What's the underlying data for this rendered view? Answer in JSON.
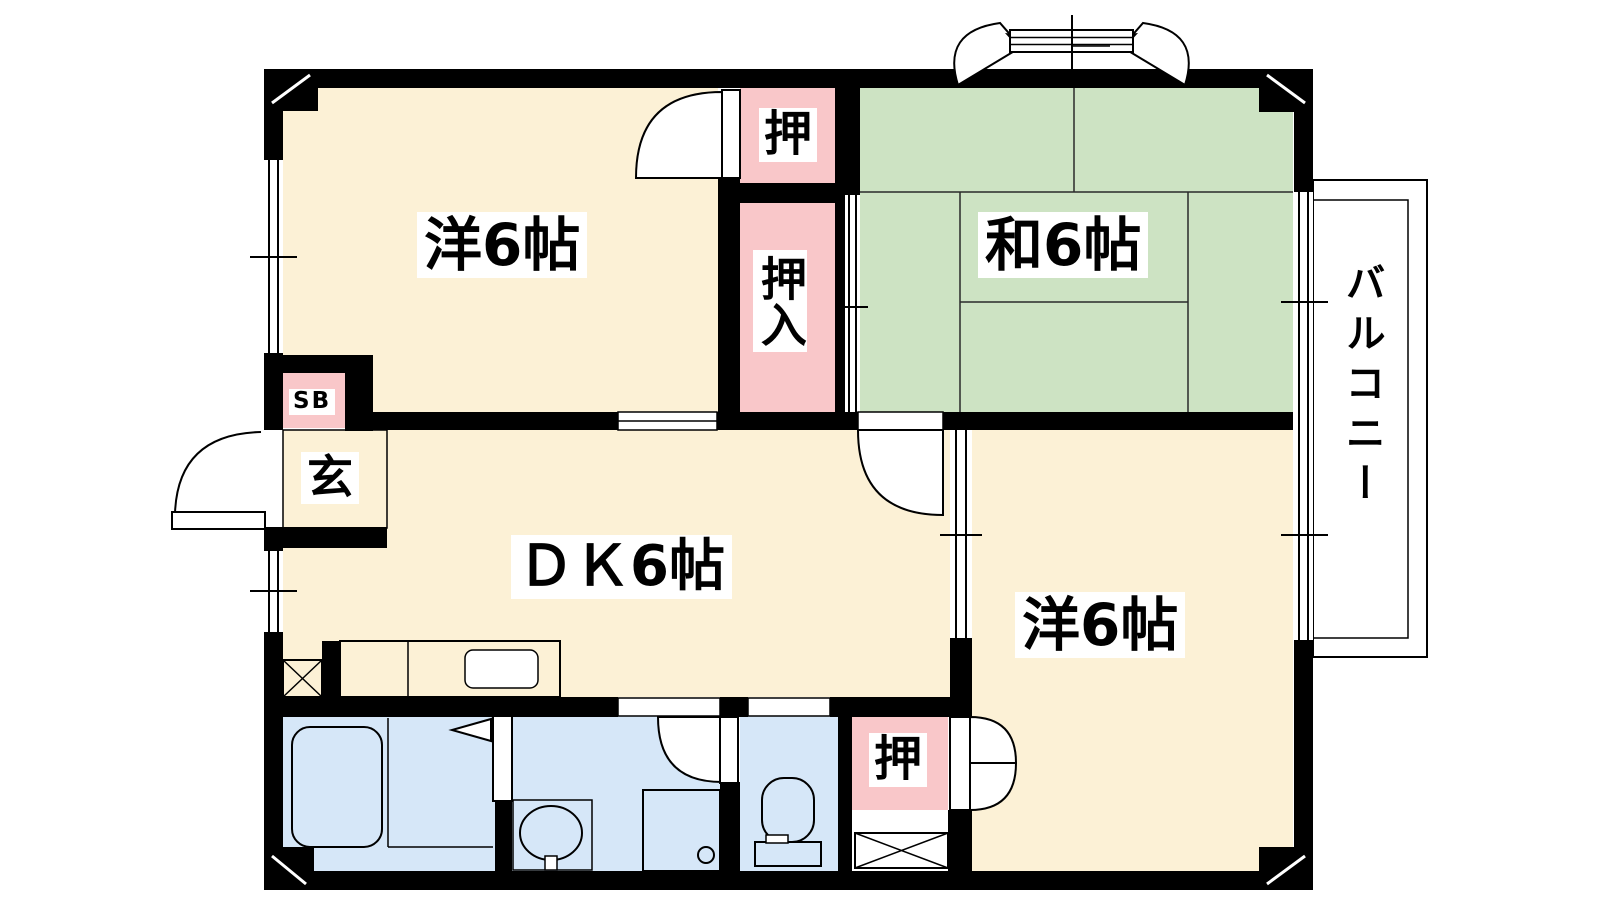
{
  "plan_title": "2DK apartment floor plan",
  "rooms": {
    "western_top": {
      "label": "洋6帖"
    },
    "japanese": {
      "label": "和6帖"
    },
    "dining_kitchen": {
      "label": "ＤＫ6帖"
    },
    "western_bottom": {
      "label": "洋6帖"
    },
    "closet_top": {
      "label": "押"
    },
    "oshiire": {
      "label": "押入"
    },
    "closet_bottom": {
      "label": "押"
    },
    "entrance": {
      "label": "玄"
    },
    "shoe_box": {
      "label": "SB"
    },
    "balcony": {
      "label": "バルコニー"
    }
  },
  "colors": {
    "wall": "#000000",
    "western_room": "#FCF1D6",
    "tatami_room": "#CDE3C3",
    "closet_pink": "#F9C7C9",
    "wet_area_blue": "#D6E7F8",
    "kitchen_counter": "#E7D9EF",
    "entrance_gray": "#D3D3D3",
    "balcony_gray": "#D3D3D3",
    "paper_white": "#FFFFFF"
  }
}
